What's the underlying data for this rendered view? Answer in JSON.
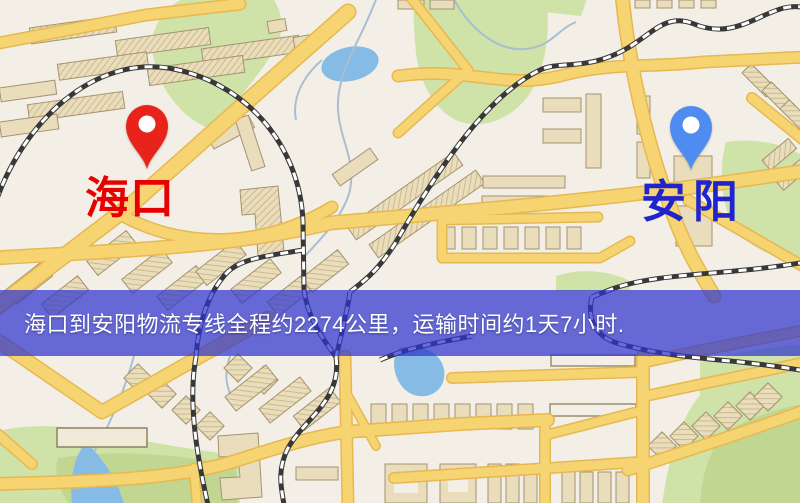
{
  "banner": {
    "text": "海口到安阳物流专线全程约2274公里，运输时间约1天7小时."
  },
  "markers": {
    "origin": {
      "label": "海口",
      "pin_color": "#e7231b",
      "label_color": "#e60202"
    },
    "destination": {
      "label": "安阳",
      "pin_color": "#4e8cf2",
      "label_color": "#2024cd"
    }
  },
  "map": {
    "colors": {
      "background": "#f3efe6",
      "road": "#f7d472",
      "road_casing": "#e6b851",
      "building": "#e9ddbb",
      "building_outline": "#a39370",
      "park": "#cfe2a8",
      "park_dark": "#c0d691",
      "water": "#86bbe6",
      "railway": "#383838",
      "banner_overlay": "rgba(47,52,206,0.72)",
      "banner_text": "#ffffff"
    },
    "icons": [
      "map-pin-icon"
    ]
  }
}
